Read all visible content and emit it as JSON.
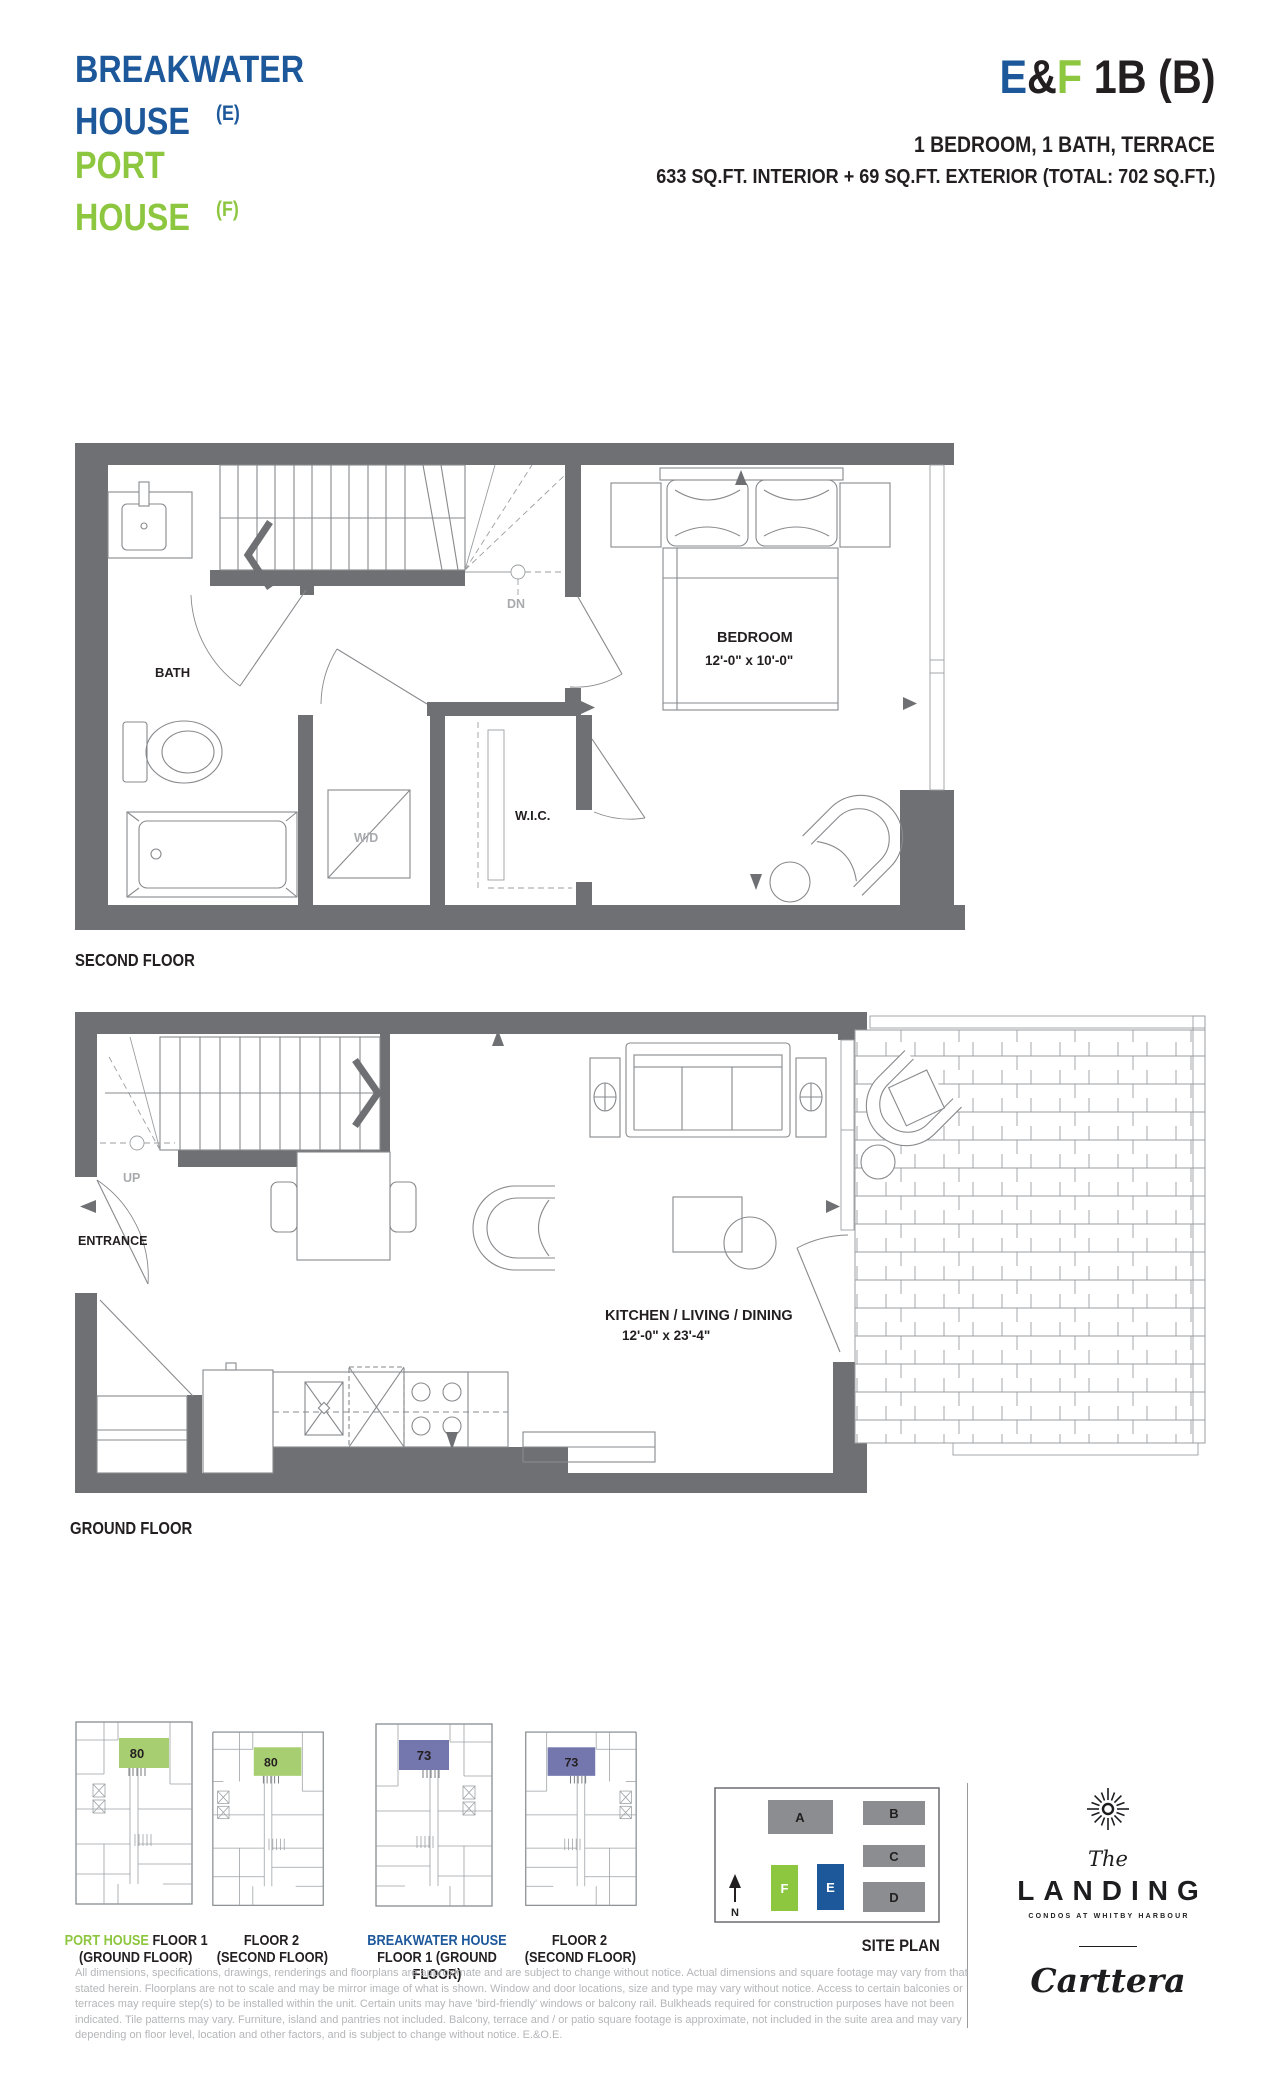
{
  "header": {
    "left": {
      "line1": "BREAKWATER",
      "line2": "HOUSE",
      "suffix1": "(E)",
      "line3": "PORT",
      "line4": "HOUSE",
      "suffix2": "(F)"
    },
    "right": {
      "unit_e": "E",
      "unit_amp": "&",
      "unit_f": "F",
      "unit_rest": " 1B (B)",
      "subtitle": "1 BEDROOM, 1 BATH, TERRACE",
      "area": "633 SQ.FT. INTERIOR + 69 SQ.FT. EXTERIOR (TOTAL: 702 SQ.FT.)"
    }
  },
  "second_floor": {
    "label": "SECOND FLOOR",
    "bath": "BATH",
    "wd": "W/D",
    "wic": "W.I.C.",
    "dn": "DN",
    "bedroom_name": "BEDROOM",
    "bedroom_dims": "12'-0\" x 10'-0\""
  },
  "ground_floor": {
    "label": "GROUND FLOOR",
    "up": "UP",
    "entrance": "ENTRANCE",
    "kld_name": "KITCHEN / LIVING / DINING",
    "kld_dims": "12'-0\" x 23'-4\""
  },
  "key_plans": [
    {
      "unit": "80",
      "line1_colored": "PORT HOUSE",
      "line1_rest": " FLOOR 1",
      "line2": "(GROUND FLOOR)"
    },
    {
      "unit": "80",
      "line1_colored": "",
      "line1_rest": "FLOOR 2",
      "line2": "(SECOND FLOOR)"
    },
    {
      "unit": "73",
      "line1_colored": "BREAKWATER HOUSE",
      "line1_rest": "",
      "line2": "FLOOR 1 (GROUND FLOOR)"
    },
    {
      "unit": "73",
      "line1_colored": "",
      "line1_rest": "FLOOR 2",
      "line2": "(SECOND FLOOR)"
    }
  ],
  "site_plan": {
    "label": "SITE PLAN",
    "north": "N",
    "buildings": [
      {
        "id": "A"
      },
      {
        "id": "B"
      },
      {
        "id": "C"
      },
      {
        "id": "D"
      },
      {
        "id": "F"
      },
      {
        "id": "E"
      }
    ]
  },
  "logo": {
    "the": "The",
    "name": "LANDING",
    "tagline": "CONDOS AT WHITBY HARBOUR",
    "developer": "Carttera"
  },
  "disclaimer": {
    "line1": "All dimensions, specifications, drawings, renderings and floorplans are approximate and are subject to change without notice. Actual dimensions and square footage may vary from that",
    "line2": "stated herein. Floorplans are not to scale and may be mirror image of what is shown. Window and door locations, size and type may vary without notice. Access to certain balconies or",
    "line3": "terraces may require step(s) to be installed within the unit. Certain units may have 'bird-friendly' windows or balcony rail. Bulkheads required for construction purposes have not been",
    "line4": "indicated. Tile patterns may vary. Furniture, island and pantries not included. Balcony, terrace and / or patio square footage is approximate, not included in the suite area and may vary",
    "line5": "depending on floor level, location and other factors, and is subject to change without notice. E.&O.E."
  },
  "colors": {
    "blue": "#1d589b",
    "green": "#8dc63f",
    "wall_gray": "#6f7073",
    "unit_green": "#a8ce72",
    "unit_purple": "#7477ae",
    "building_gray": "#8b8d90"
  }
}
